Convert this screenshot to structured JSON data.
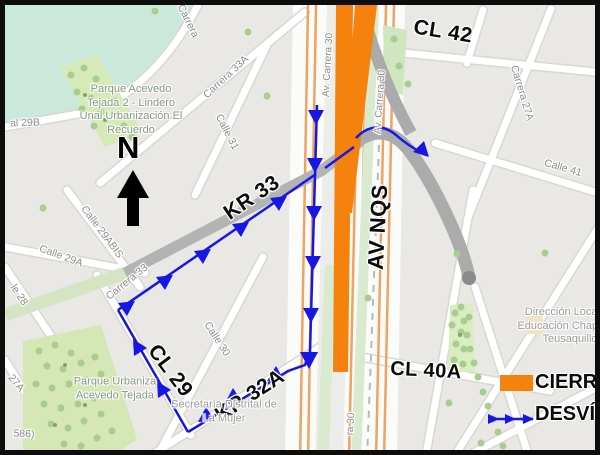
{
  "map_colors": {
    "closure_orange": "#F5820D",
    "detour_blue": "#1717E3",
    "water_teal": "#cbe9db",
    "park_green": "#d6eab8",
    "road_gray": "#ababab"
  },
  "compass": {
    "letter": "N"
  },
  "route_labels": {
    "cl42": "CL 42",
    "kr33": "KR 33",
    "av_nqs": "AV NQS",
    "cl29": "CL 29",
    "kr32a": "KR 32A",
    "cl40a": "CL 40A"
  },
  "street_labels": {
    "al29b": "al 29B",
    "carrera_top": "Carrera",
    "carrera33a": "Carrera 33A",
    "calle31": "Calle 31",
    "calle29a": "Calle 29A",
    "calle29abis": "Calle 29ABIS",
    "carrera33": "Carrera 33",
    "calle30": "Calle 30",
    "le28": "le 28",
    "c27a": "27A",
    "n586": "586)",
    "calle41": "Calle 41",
    "carrera27a": "Carrera 27A",
    "av_carrera30_w": "Av. Carrera 30",
    "av_carrera30_e": "Av. Carrera 30",
    "ra30": "ra 30"
  },
  "poi_labels": {
    "parque_acevedo": [
      "Parque Acevedo",
      "Tejada 2 - Lindero",
      "Unal Urbanización El",
      "Recuerdo"
    ],
    "parque_urb": [
      "Parque Urbaniza",
      "Acevedo Tejada"
    ],
    "secretaria": [
      "Secretaría Distrital de",
      "La Mujer"
    ],
    "direccion": [
      "Dirección Local de",
      "Educación Chapinero",
      "Teusaquillo"
    ]
  },
  "legend": {
    "closure_label": "CIERRE",
    "detour_label": "DESVÍO"
  }
}
